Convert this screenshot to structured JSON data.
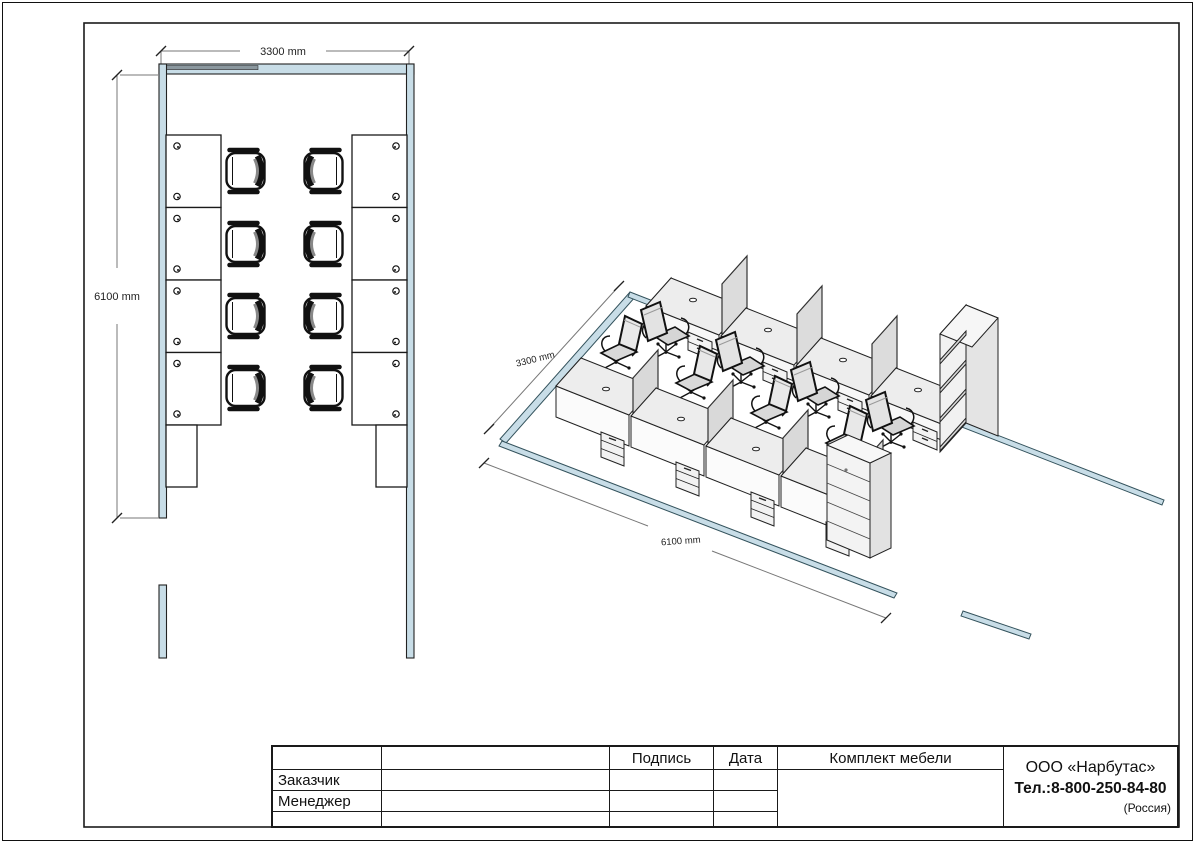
{
  "plan_view": {
    "width_dimension": "3300 mm",
    "depth_dimension": "6100 mm",
    "desk_count": 8,
    "chair_count": 8
  },
  "iso_view": {
    "width_dimension": "3300 mm",
    "depth_dimension": "6100 mm",
    "desk_count": 8,
    "chair_count": 8
  },
  "title_block": {
    "col_signature": "Подпись",
    "col_date": "Дата",
    "row_customer": "Заказчик",
    "row_manager": "Менеджер",
    "project_title": "Комплект мебели",
    "company_name": "ООО «Нарбутас»",
    "company_phone": "Тел.:8-800-250-84-80",
    "company_country": "(Россия)"
  },
  "colors": {
    "wall_fill": "#c8dde7",
    "wall_window": "#8a979e",
    "line": "#1a1a1a",
    "dim_line": "#777777"
  }
}
